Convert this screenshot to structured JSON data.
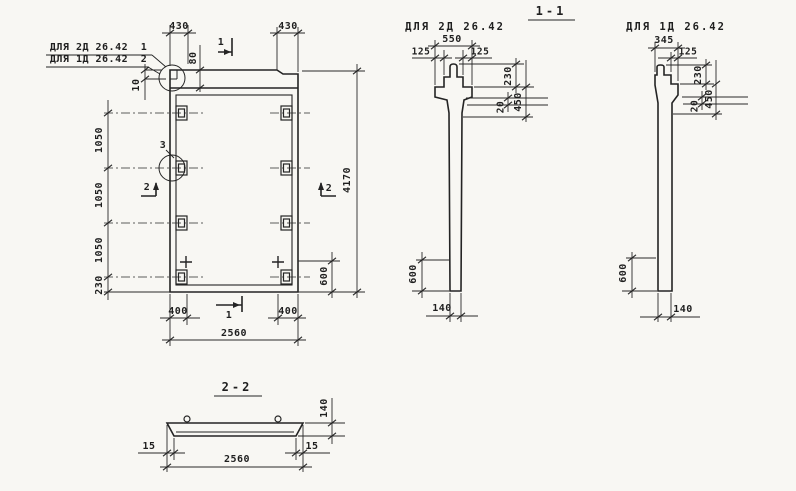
{
  "meta": {
    "paper_color": "#f8f7f3",
    "ink_color": "#242424"
  },
  "notes": {
    "line1": {
      "text": "ДЛЯ 2Д 26.42",
      "ref": "1"
    },
    "line2": {
      "text": "ДЛЯ 1Д 26.42",
      "ref": "2"
    }
  },
  "front": {
    "top_430_left": "430",
    "top_430_right": "430",
    "dim_80": "80",
    "dim_10": "10",
    "left_dims": [
      "1050",
      "1050",
      "1050",
      "230"
    ],
    "dim_4170": "4170",
    "dim_600": "600",
    "bottom_400_left": "400",
    "bottom_400_right": "400",
    "dim_2560": "2560",
    "detail_ref": "3",
    "section1_label": "1",
    "section2_label": "2"
  },
  "section11": {
    "title": "1-1",
    "left": {
      "header": "ДЛЯ 2Д 26.42",
      "dim_550": "550",
      "dim_125_l": "125",
      "dim_125_r": "125",
      "dim_230": "230",
      "dim_450": "450",
      "dim_20": "20",
      "dim_600": "600",
      "dim_140": "140"
    },
    "right": {
      "header": "ДЛЯ 1Д 26.42",
      "dim_345": "345",
      "dim_125": "125",
      "dim_230": "230",
      "dim_450": "450",
      "dim_20": "20",
      "dim_600": "600",
      "dim_140": "140"
    }
  },
  "section22": {
    "title": "2-2",
    "dim_140": "140",
    "dim_15_l": "15",
    "dim_15_r": "15",
    "dim_2560": "2560"
  }
}
